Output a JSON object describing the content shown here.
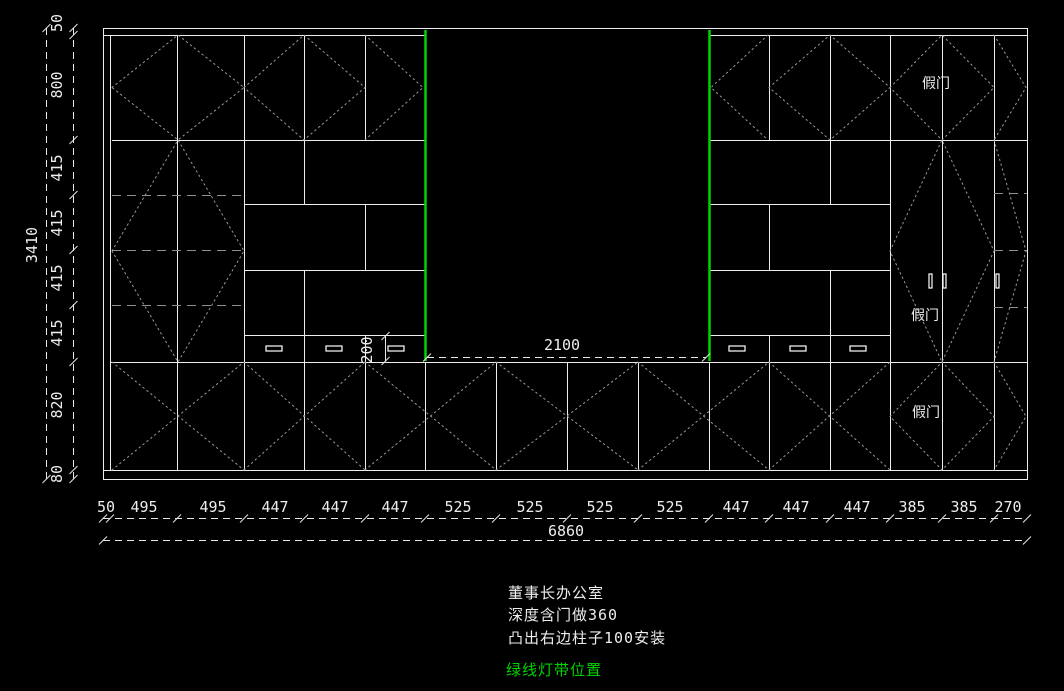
{
  "drawing": {
    "title_note_lines": [
      "董事长办公室",
      "深度含门做360",
      "凸出右边柱子100安装"
    ],
    "green_note": "绿线灯带位置",
    "fake_door_label": "假门",
    "dimensions": {
      "left_chain": [
        "50",
        "800",
        "415",
        "415",
        "415",
        "415",
        "820",
        "80"
      ],
      "left_total": "3410",
      "bottom_chain": [
        "50",
        "495",
        "495",
        "447",
        "447",
        "447",
        "525",
        "525",
        "525",
        "525",
        "447",
        "447",
        "447",
        "385",
        "385",
        "270"
      ],
      "bottom_total": "6860",
      "niche_width": "2100",
      "drawer_height": "200"
    },
    "colors": {
      "background": "#000000",
      "structure_line": "#ededed",
      "dimension_line": "#e8e8e8",
      "door_swing_dotted": "#9a9a9a",
      "shelf_dashed": "#8f8f8f",
      "light_strip_green": "#00d400"
    }
  }
}
